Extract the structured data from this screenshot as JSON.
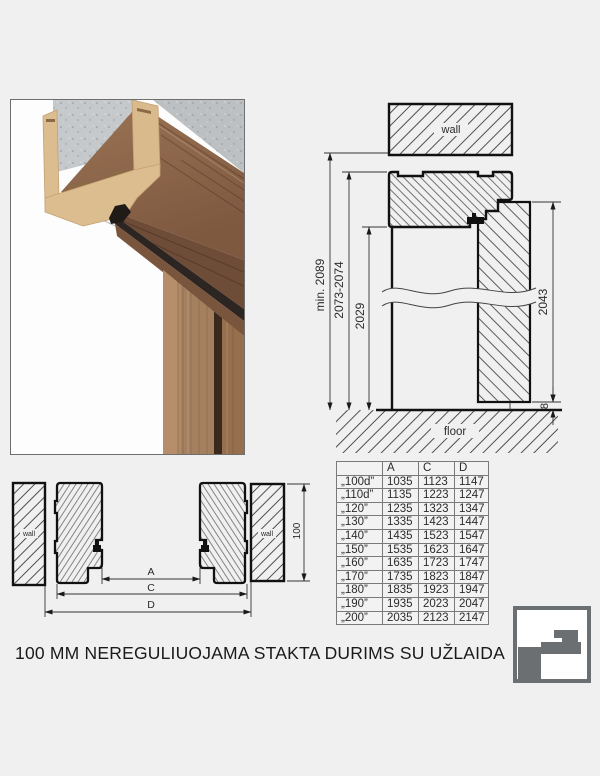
{
  "caption": "100 MM NEREGULIUOJAMA STAKTA DURIMS SU UŽLAIDA",
  "vertical_section": {
    "wall_label": "wall",
    "floor_label": "floor",
    "min_total_height": "min. 2089",
    "frame_outer_height": "2073-2074",
    "opening_height": "2029",
    "door_leaf_height": "2043",
    "floor_gap": "8"
  },
  "horizontal_section": {
    "wall_label_left": "wall",
    "wall_label_right": "wall",
    "dim_clear_width": "A",
    "dim_frame_outer": "C",
    "dim_wall_opening": "D",
    "frame_depth": "100"
  },
  "table": {
    "headers": [
      "",
      "A",
      "C",
      "D"
    ],
    "rows": [
      {
        "label": "„100d”",
        "a": "1035",
        "c": "1123",
        "d": "1147"
      },
      {
        "label": "„110d”",
        "a": "1135",
        "c": "1223",
        "d": "1247"
      },
      {
        "label": "„120”",
        "a": "1235",
        "c": "1323",
        "d": "1347"
      },
      {
        "label": "„130”",
        "a": "1335",
        "c": "1423",
        "d": "1447"
      },
      {
        "label": "„140”",
        "a": "1435",
        "c": "1523",
        "d": "1547"
      },
      {
        "label": "„150”",
        "a": "1535",
        "c": "1623",
        "d": "1647"
      },
      {
        "label": "„160”",
        "a": "1635",
        "c": "1723",
        "d": "1747"
      },
      {
        "label": "„170”",
        "a": "1735",
        "c": "1823",
        "d": "1847"
      },
      {
        "label": "„180”",
        "a": "1835",
        "c": "1923",
        "d": "1947"
      },
      {
        "label": "„190”",
        "a": "1935",
        "c": "2023",
        "d": "2047"
      },
      {
        "label": "„200”",
        "a": "2035",
        "c": "2123",
        "d": "2147"
      }
    ]
  },
  "colors": {
    "background": "#f0f0f1",
    "drawing_line": "#1a1a1a",
    "wood": "#8a6248",
    "mdf": "#d9ba8c",
    "concrete": "#c6c9cb",
    "seal": "#211b18",
    "logo_gray": "#6c6f71"
  }
}
